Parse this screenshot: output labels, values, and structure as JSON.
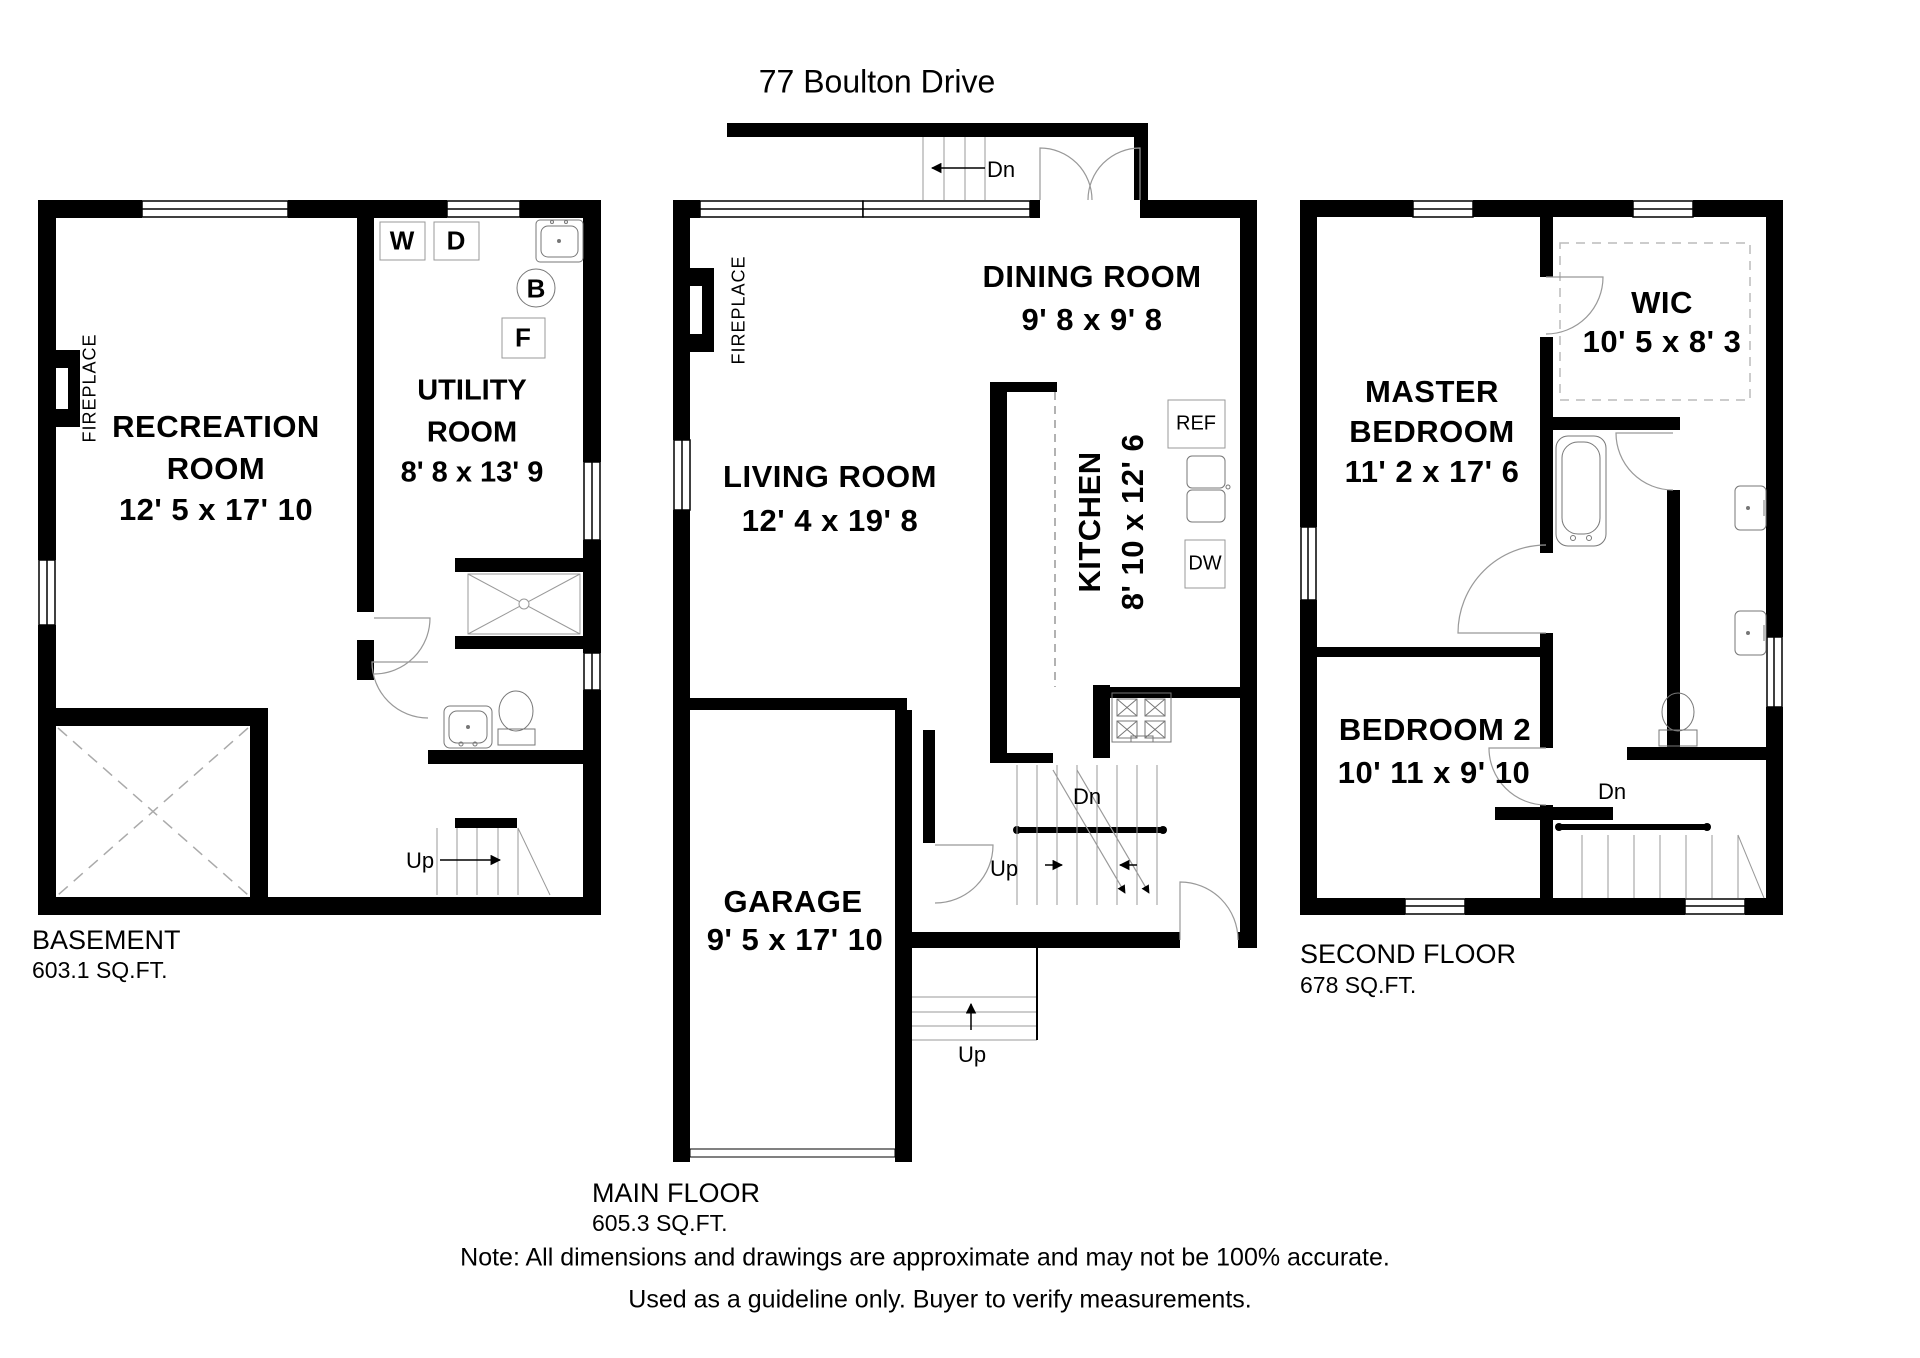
{
  "title": "77 Boulton Drive",
  "note": {
    "line1": "Note: All dimensions and drawings are approximate and may not be 100% accurate.",
    "line2": "Used as a guideline only. Buyer to verify measurements."
  },
  "basement": {
    "name": "BASEMENT",
    "area": "603.1 SQ.FT.",
    "recreation_line1": "RECREATION",
    "recreation_line2": "ROOM",
    "recreation_dims": "12' 5 x 17' 10",
    "utility_line1": "UTILITY",
    "utility_line2": "ROOM",
    "utility_dims": "8' 8 x 13' 9",
    "fireplace": "FIREPLACE",
    "washer": "W",
    "dryer": "D",
    "boiler": "B",
    "furnace": "F",
    "stairs_up": "Up"
  },
  "main": {
    "name": "MAIN FLOOR",
    "area": "605.3 SQ.FT.",
    "living_line1": "LIVING ROOM",
    "living_dims": "12' 4 x 19' 8",
    "dining_line1": "DINING ROOM",
    "dining_dims": "9' 8 x 9' 8",
    "kitchen_line1": "KITCHEN",
    "kitchen_dims": "8' 10 x 12' 6",
    "garage_line1": "GARAGE",
    "garage_dims": "9' 5 x 17' 10",
    "fireplace": "FIREPLACE",
    "fridge": "REF",
    "dishwasher": "DW",
    "porch_down": "Dn",
    "stairs_down": "Dn",
    "stairs_up": "Up",
    "entry_up": "Up"
  },
  "second": {
    "name": "SECOND FLOOR",
    "area": "678 SQ.FT.",
    "master_line1": "MASTER",
    "master_line2": "BEDROOM",
    "master_dims": "11' 2 x 17' 6",
    "wic_line1": "WIC",
    "wic_dims": "10' 5 x 8' 3",
    "bedroom2_line1": "BEDROOM 2",
    "bedroom2_dims": "10' 11 x 9' 10",
    "stairs_down": "Dn"
  }
}
